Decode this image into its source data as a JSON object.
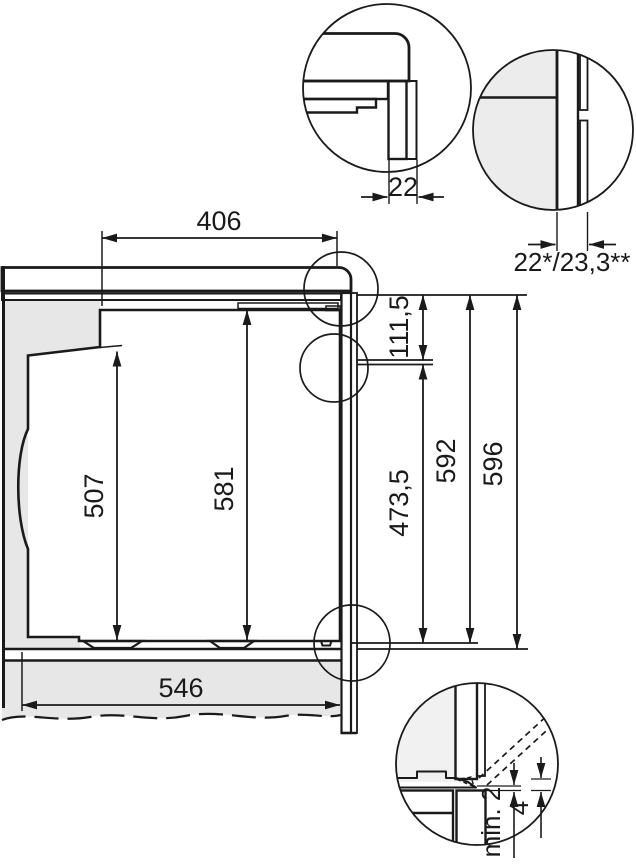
{
  "diagram": {
    "title": "built-in oven installation dimension drawing",
    "colors": {
      "line": "#1a1a1a",
      "panel_fill": "#e7e7e7",
      "interior_fill": "#f6f6f6",
      "detail_left_fill": "#ececec",
      "door_strip_fill": "#cfcfcf",
      "top_rail_fill": "#999999",
      "floor_profile_fill": "#b5b5b5",
      "background": "#ffffff"
    },
    "dims": {
      "top_depth": "406",
      "detail_front_thickness": "22",
      "detail_front_thickness_variants": "22*/23,3**",
      "control_panel_height": "111,5",
      "rear_body_height": "507",
      "cavity_front_height": "581",
      "door_height": "473,5",
      "appliance_height": "592",
      "niche_height": "596",
      "shelf_depth": "546",
      "rear_gap": "min. 2",
      "bottom_front_gap": "4"
    }
  }
}
